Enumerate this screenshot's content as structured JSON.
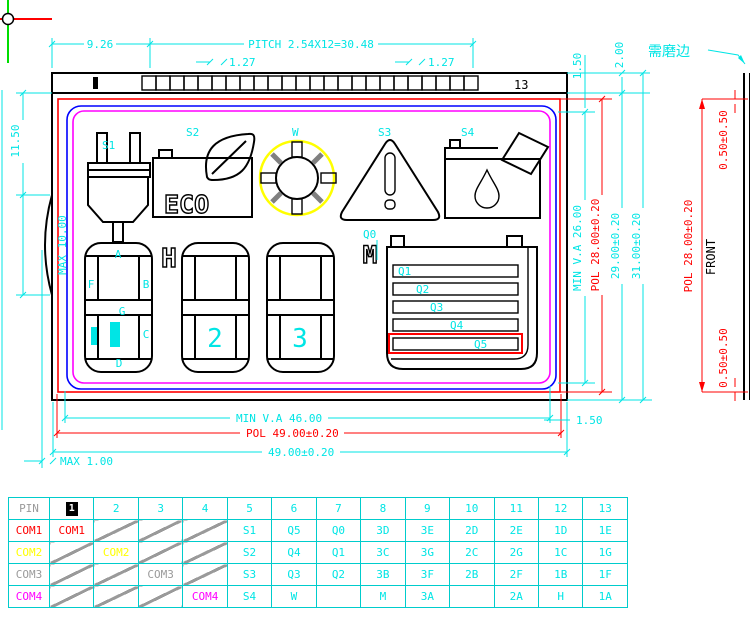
{
  "drawing": {
    "top_dims": {
      "d926": "9.26",
      "pitch": "PITCH 2.54X12=30.48",
      "d127_left": "1.27",
      "d127_right": "1.27",
      "pin13": "13",
      "d150": "1.50",
      "d200": "2.00"
    },
    "left_dims": {
      "d1150": "11.50",
      "max10": "MAX 10.00"
    },
    "bottom_dims": {
      "minva": "MIN V.A 46.00",
      "pol": "POL 49.00±0.20",
      "glass": "49.00±0.20",
      "max1": "MAX 1.00",
      "d150": "1.50"
    },
    "right_dims": {
      "minva": "MIN V.A 26.00",
      "pol": "POL 28.00±0.20",
      "glass": "29.00±0.20",
      "total": "31.00±0.20"
    },
    "side_view": {
      "grind_note": "需磨边",
      "front": "FRONT",
      "pol": "POL 28.00±0.20",
      "top_inset": "0.50±0.50",
      "bottom_inset": "0.50±0.50"
    },
    "icons": {
      "s1": "S1",
      "s2": "S2",
      "w": "W",
      "s3": "S3",
      "s4": "S4",
      "eco": "ECO",
      "q0": "Q0"
    },
    "segments": {
      "a": "A",
      "f": "F",
      "b": "B",
      "g": "G",
      "c": "C",
      "d": "D",
      "h": "H",
      "m": "M",
      "digit2": "2",
      "digit3": "3",
      "q1": "Q1",
      "q2": "Q2",
      "q3": "Q3",
      "q4": "Q4",
      "q5": "Q5"
    },
    "colors": {
      "outline": "#000000",
      "pol": "#ff0000",
      "va": "#0000ff",
      "inner": "#ff00ff",
      "dims": "#00e5e5",
      "sun_ring": "#ffff00"
    }
  },
  "pin_table": {
    "headers": [
      "PIN",
      "1",
      "2",
      "3",
      "4",
      "5",
      "6",
      "7",
      "8",
      "9",
      "10",
      "11",
      "12",
      "13"
    ],
    "rows": [
      {
        "label": "COM1",
        "color": "#ff0000",
        "cells": [
          "COM1",
          "/",
          "/",
          "/",
          "S1",
          "Q5",
          "Q0",
          "3D",
          "3E",
          "2D",
          "2E",
          "1D",
          "1E"
        ]
      },
      {
        "label": "COM2",
        "color": "#ffff00",
        "cells": [
          "/",
          "COM2",
          "/",
          "/",
          "S2",
          "Q4",
          "Q1",
          "3C",
          "3G",
          "2C",
          "2G",
          "1C",
          "1G"
        ]
      },
      {
        "label": "COM3",
        "color": "#9a9a9a",
        "cells": [
          "/",
          "/",
          "COM3",
          "/",
          "S3",
          "Q3",
          "Q2",
          "3B",
          "3F",
          "2B",
          "2F",
          "1B",
          "1F"
        ]
      },
      {
        "label": "COM4",
        "color": "#ff00ff",
        "cells": [
          "/",
          "/",
          "/",
          "COM4",
          "S4",
          "W",
          "",
          "M",
          "3A",
          "",
          "2A",
          "H",
          "1A"
        ]
      }
    ]
  }
}
